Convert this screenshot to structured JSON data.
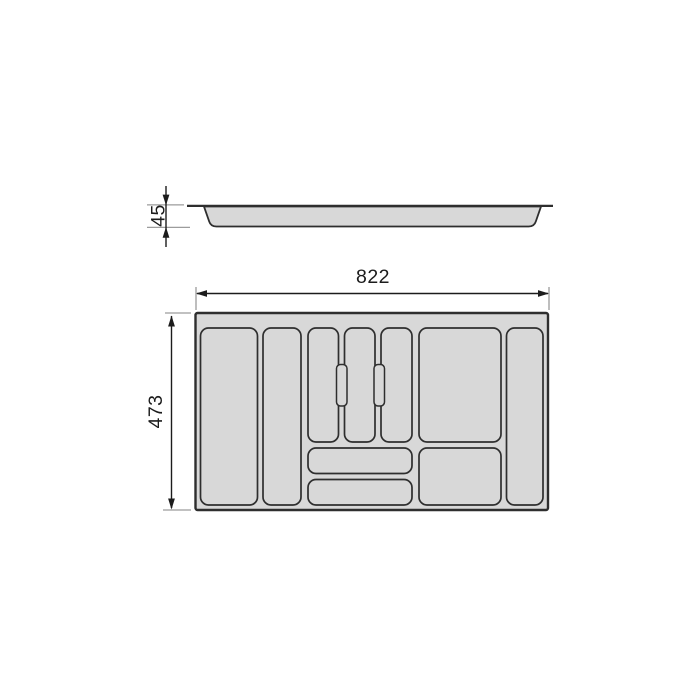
{
  "drawing": {
    "name": "Cutlery tray insert technical drawing, side and top views",
    "views": {
      "side": {
        "height_dim": {
          "value": "45"
        }
      },
      "top": {
        "width_dim": {
          "value": "822"
        },
        "depth_dim": {
          "value": "473"
        },
        "compartment_count": 10,
        "divider_tab_count": 2
      }
    },
    "colors": {
      "page_bg": "#ffffff",
      "tray_fill": "#d8d8d8",
      "outline": "#2e2e2e",
      "dim_line": "#1c1c1c",
      "ext_line": "#9c9c9c",
      "label_text": "#1c1c1c"
    }
  }
}
